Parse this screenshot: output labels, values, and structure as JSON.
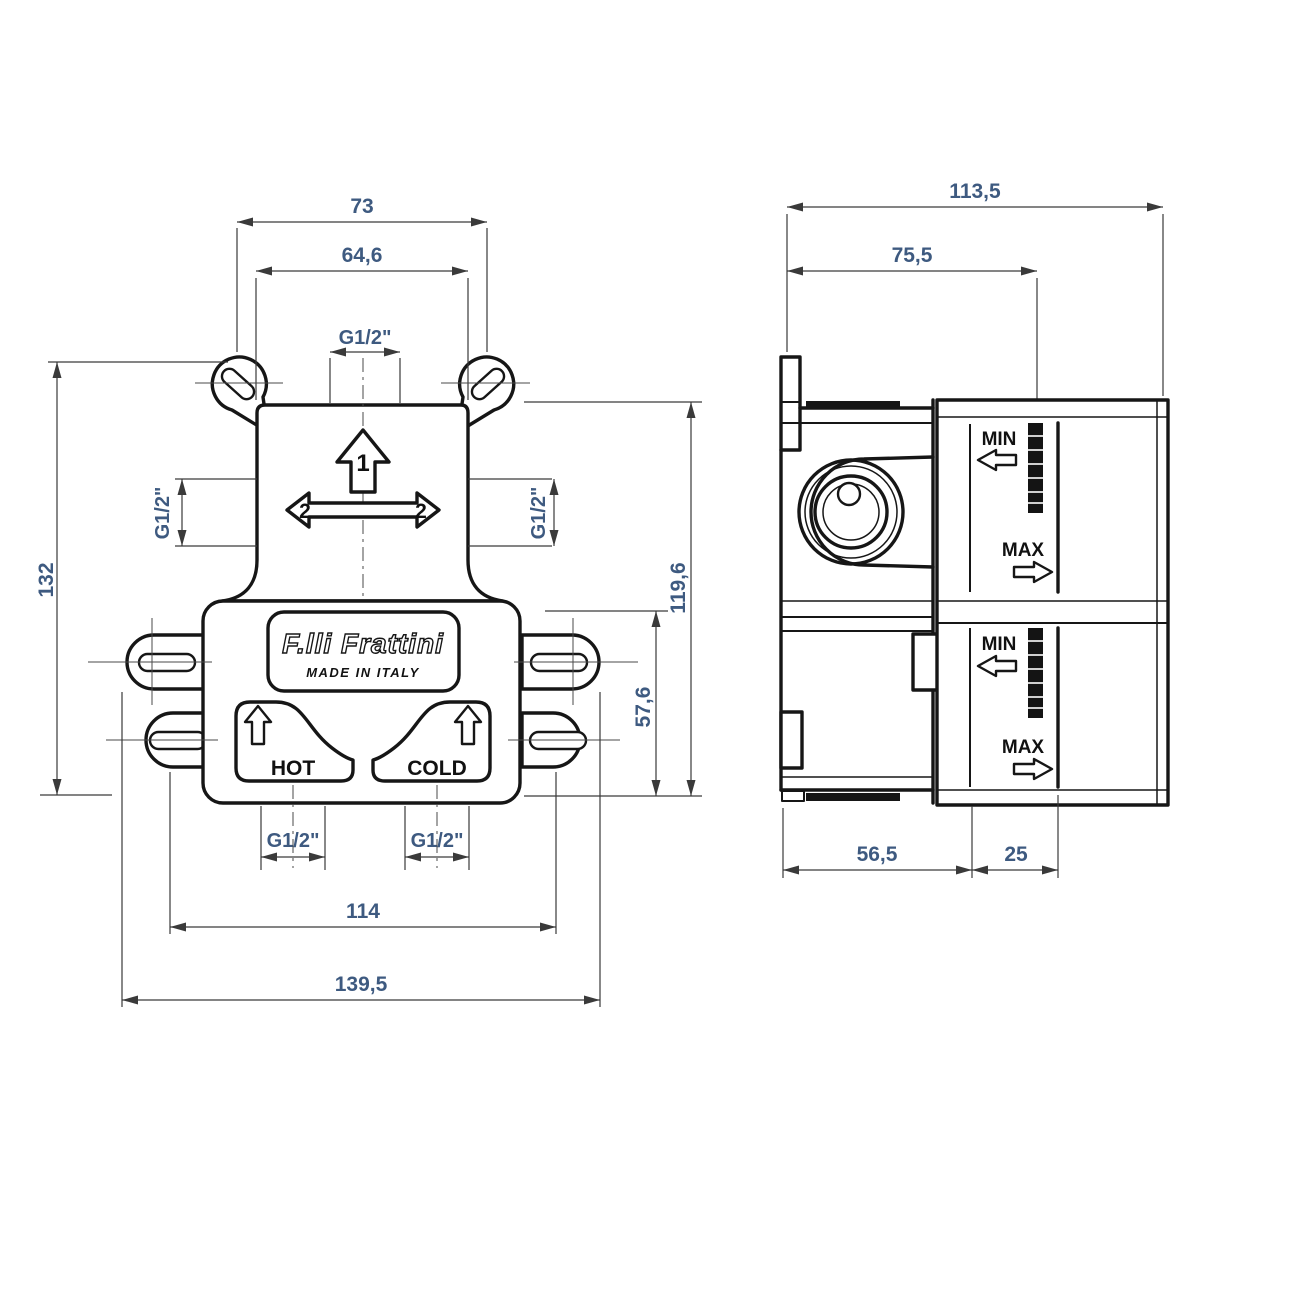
{
  "colors": {
    "line": "#161616",
    "dim_text": "#3e5a80",
    "label_text": "#111111",
    "background": "#ffffff"
  },
  "front_view": {
    "dims": {
      "d73": "73",
      "d646": "64,6",
      "g12_top": "G1/2\"",
      "d132": "132",
      "g12_left": "G1/2\"",
      "g12_right": "G1/2\"",
      "d1196": "119,6",
      "d576": "57,6",
      "g12_hot": "G1/2\"",
      "g12_cold": "G1/2\"",
      "d114": "114",
      "d1395": "139,5"
    },
    "labels": {
      "brand": "F.lli Frattini",
      "made_in": "MADE IN ITALY",
      "hot": "HOT",
      "cold": "COLD",
      "arrow1": "1",
      "arrow2_left": "2",
      "arrow2_right": "2"
    }
  },
  "side_view": {
    "dims": {
      "d1135": "113,5",
      "d755": "75,5",
      "d565": "56,5",
      "d25": "25"
    },
    "labels": {
      "upper_min": "MIN",
      "upper_max": "MAX",
      "lower_min": "MIN",
      "lower_max": "MAX"
    }
  }
}
